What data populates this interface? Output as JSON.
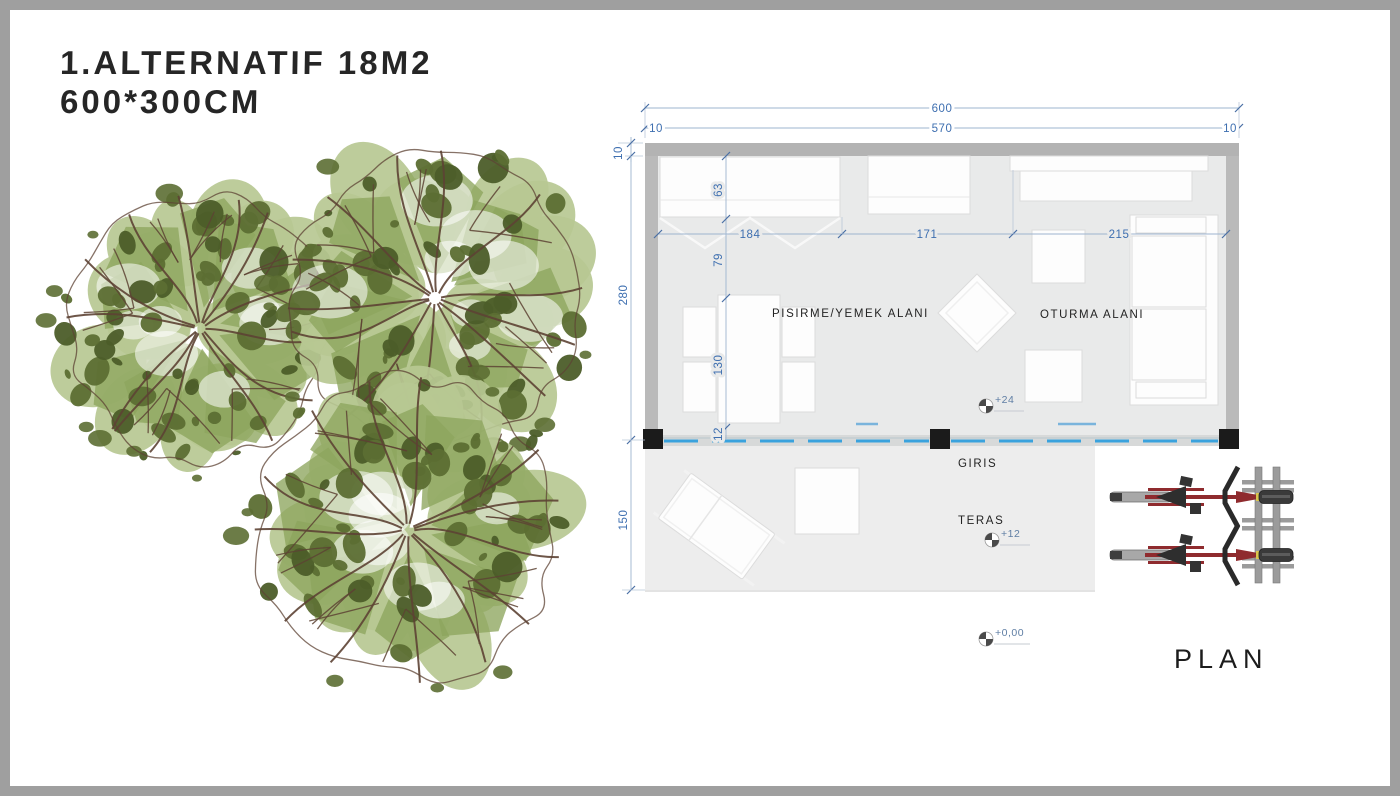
{
  "title": {
    "line1": "1.ALTERNATIF 18M2",
    "line2": "600*300CM"
  },
  "plan": {
    "caption": "PLAN",
    "rooms": {
      "cooking_dining": "PISIRME/YEMEK ALANI",
      "sitting": "OTURMA ALANI",
      "entrance": "GIRIS",
      "terrace": "TERAS"
    },
    "levels": {
      "interior": "+24",
      "terrace": "+12",
      "ground": "+0,00"
    },
    "dimensions": {
      "total_width": "600",
      "inner_width": "570",
      "wall_left": "10",
      "wall_right": "10",
      "wall_top": "10",
      "inner_height": "280",
      "terrace_depth": "150",
      "counter_depth": "63",
      "counter_width": "184",
      "middle_span": "171",
      "sitting_span": "215",
      "counter_to_table": "79",
      "table_length": "130",
      "table_to_glass": "12"
    }
  },
  "colors": {
    "frame": "#9f9f9f",
    "wall": "#b5b5b5",
    "floor": "#e9eaea",
    "terrace": "#ededed",
    "column": "#1b1b1b",
    "dim_text": "#3e6fb0",
    "dim_line": "#9db4cf",
    "glass_blue": "#3aa2dd",
    "label_text": "#232323",
    "bike_red": "#8f2b2e",
    "rack_gray": "#9b9b9b",
    "tree": {
      "light": "#b7c893",
      "mid": "#8da55e",
      "dark": "#5c6e33",
      "deep": "#4c5d29",
      "branch": "#5d4334"
    }
  },
  "trees": {
    "items": [
      {
        "cx": 170,
        "cy": 228,
        "r": 138,
        "seed": 7
      },
      {
        "cx": 405,
        "cy": 198,
        "r": 152,
        "seed": 13
      },
      {
        "cx": 378,
        "cy": 430,
        "r": 158,
        "seed": 29
      }
    ]
  }
}
